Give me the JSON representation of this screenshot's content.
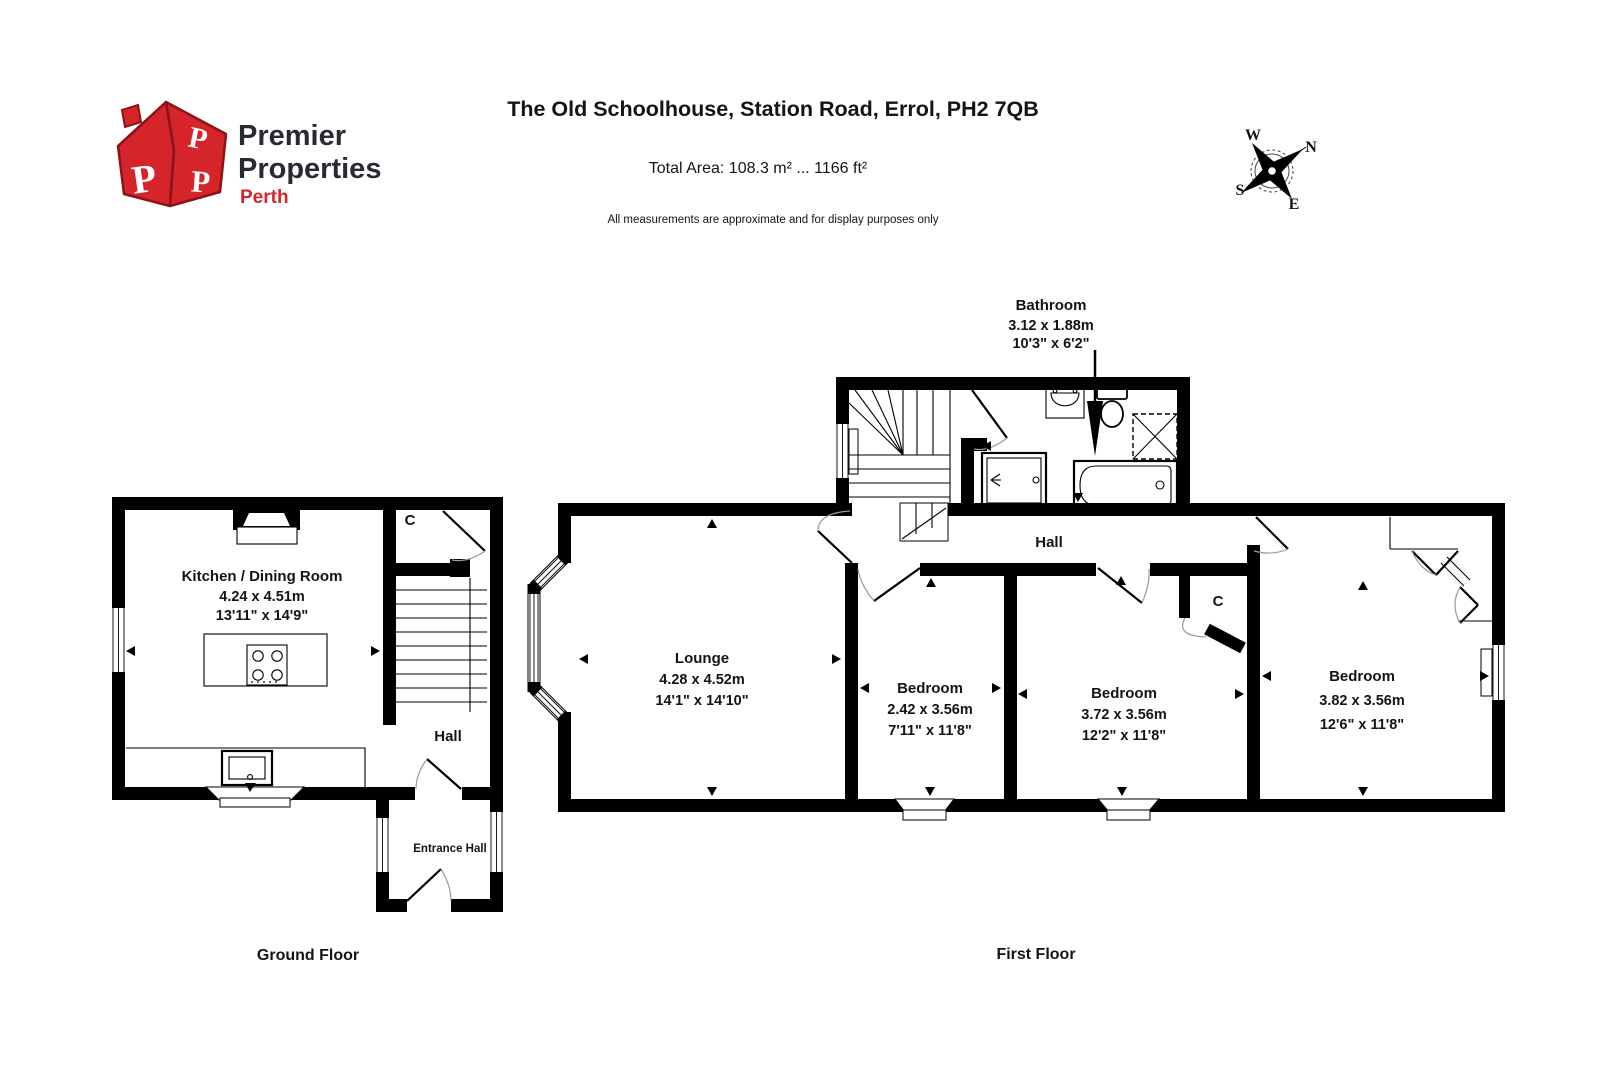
{
  "header": {
    "logo": {
      "name_line1": "Premier",
      "name_line2": "Properties",
      "region": "Perth",
      "monogram": "P"
    },
    "title": "The Old Schoolhouse, Station Road, Errol, PH2 7QB",
    "total_area": "Total Area: 108.3 m² ... 1166 ft²",
    "disclaimer": "All measurements are approximate and for display purposes only",
    "compass": {
      "n": "N",
      "e": "E",
      "s": "S",
      "w": "W"
    }
  },
  "ground_floor": {
    "caption": "Ground Floor",
    "kitchen": {
      "name": "Kitchen / Dining Room",
      "metric": "4.24 x 4.51m",
      "imperial": "13'11\" x 14'9\""
    },
    "hall": {
      "name": "Hall"
    },
    "entrance_hall": {
      "name": "Entrance Hall"
    },
    "cupboard": {
      "name": "C"
    }
  },
  "first_floor": {
    "caption": "First Floor",
    "lounge": {
      "name": "Lounge",
      "metric": "4.28 x 4.52m",
      "imperial": "14'1\" x 14'10\""
    },
    "bedroom1": {
      "name": "Bedroom",
      "metric": "2.42 x 3.56m",
      "imperial": "7'11\" x 11'8\""
    },
    "bedroom2": {
      "name": "Bedroom",
      "metric": "3.72 x 3.56m",
      "imperial": "12'2\" x 11'8\""
    },
    "bedroom3": {
      "name": "Bedroom",
      "metric": "3.82 x 3.56m",
      "imperial": "12'6\" x 11'8\""
    },
    "bathroom": {
      "name": "Bathroom",
      "metric": "3.12 x 1.88m",
      "imperial": "10'3\" x 6'2\""
    },
    "hall": {
      "name": "Hall"
    },
    "cupboard": {
      "name": "C"
    }
  },
  "colors": {
    "wall": "#000000",
    "brand_red": "#d6242b",
    "text_dark": "#141414"
  }
}
